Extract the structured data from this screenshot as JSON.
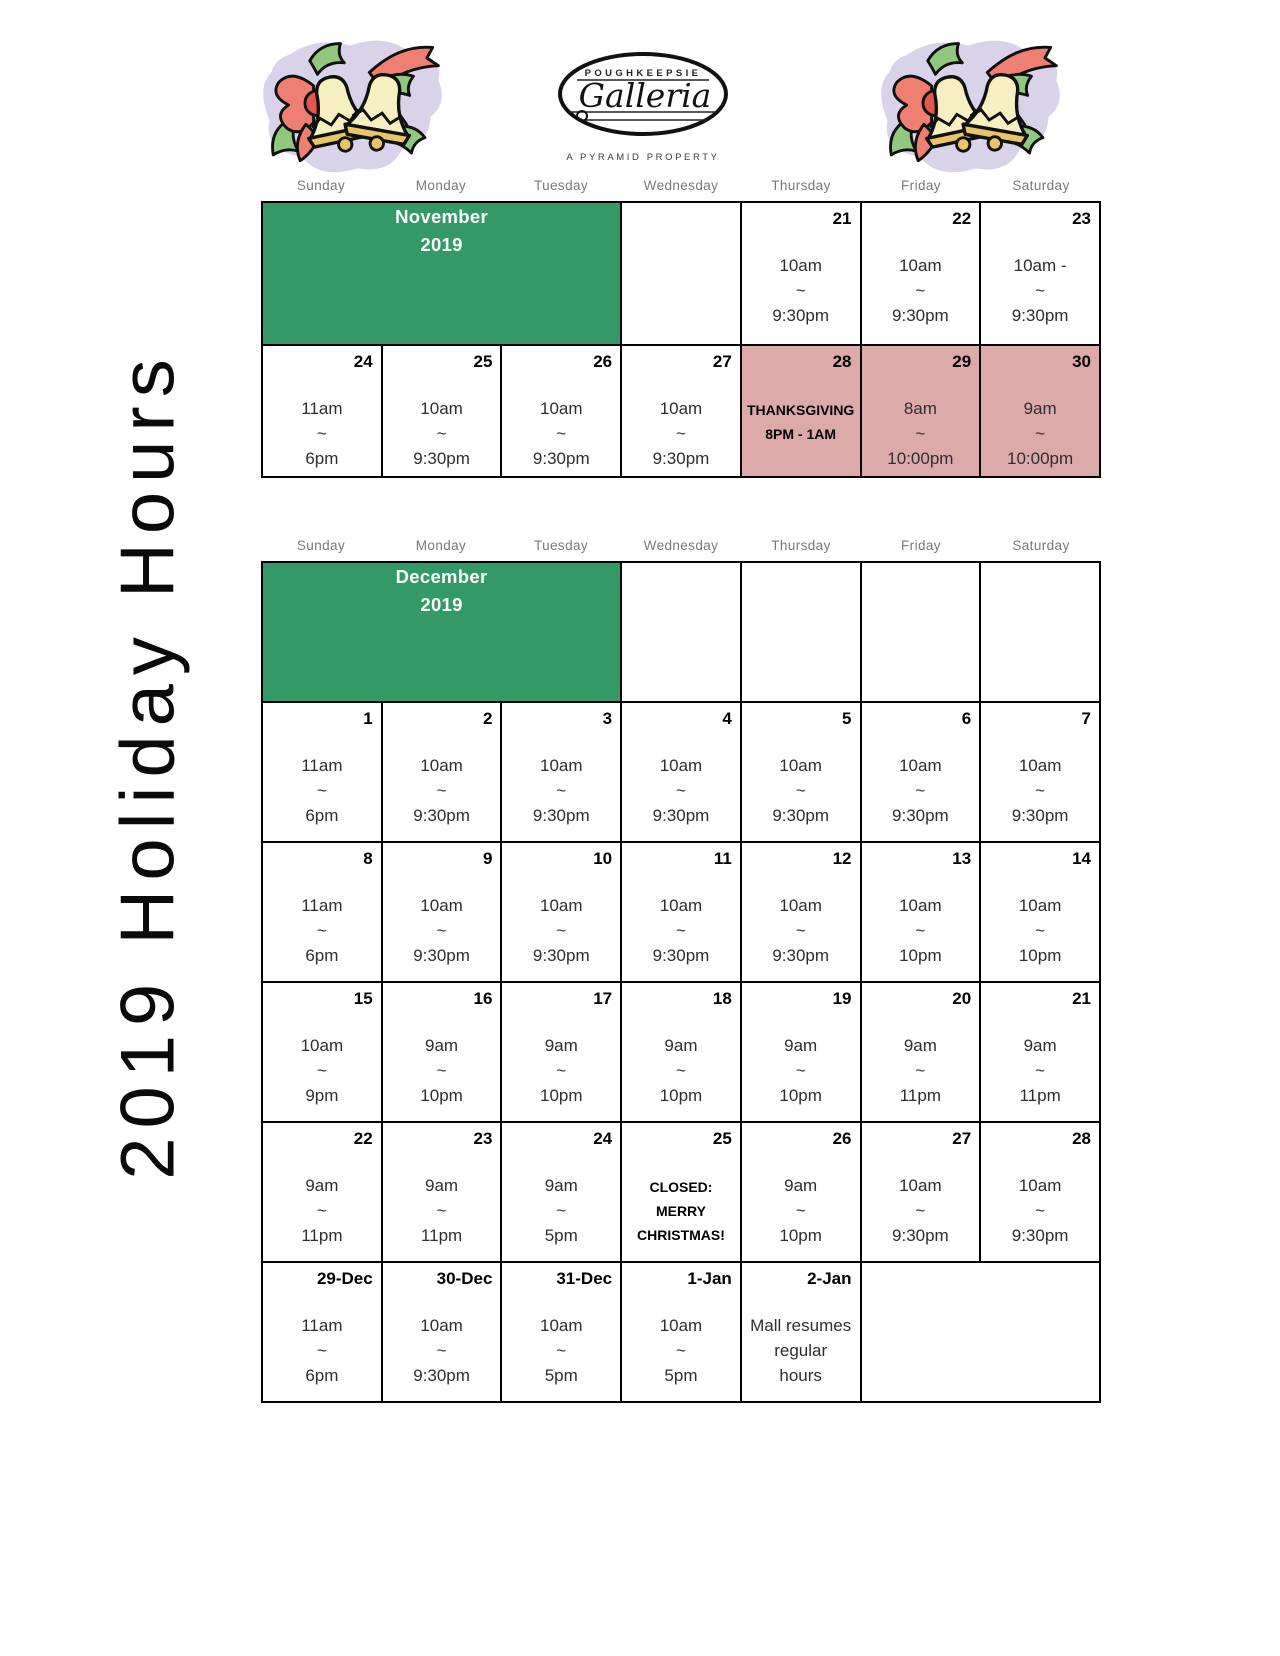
{
  "page": {
    "vertical_title": "2019 Holiday Hours"
  },
  "logo": {
    "name": "POUGHKEEPSIE",
    "script": "Galleria",
    "tagline": "A PYRAMID PROPERTY"
  },
  "weekdays": [
    "Sunday",
    "Monday",
    "Tuesday",
    "Wednesday",
    "Thursday",
    "Friday",
    "Saturday"
  ],
  "colors": {
    "month_green": "#339966",
    "holiday_pink": "#ddaaaa"
  },
  "months": [
    {
      "id": "november",
      "title_lines": [
        "November",
        "2019"
      ],
      "first_row_cells": [
        {
          "type": "empty"
        },
        {
          "date": "21",
          "lines": [
            "10am",
            "~",
            "9:30pm"
          ]
        },
        {
          "date": "22",
          "lines": [
            "10am",
            "~",
            "9:30pm"
          ]
        },
        {
          "date": "23",
          "lines": [
            "10am -",
            "~",
            "9:30pm"
          ]
        }
      ],
      "rows": [
        [
          {
            "date": "24",
            "lines": [
              "11am",
              "~",
              "6pm"
            ]
          },
          {
            "date": "25",
            "lines": [
              "10am",
              "~",
              "9:30pm"
            ]
          },
          {
            "date": "26",
            "lines": [
              "10am",
              "~",
              "9:30pm"
            ]
          },
          {
            "date": "27",
            "lines": [
              "10am",
              "~",
              "9:30pm"
            ]
          },
          {
            "date": "28",
            "lines": [
              "THANKSGIVING",
              "8PM - 1AM"
            ],
            "bold": true,
            "highlight": true
          },
          {
            "date": "29",
            "lines": [
              "8am",
              "~",
              "10:00pm"
            ],
            "highlight": true
          },
          {
            "date": "30",
            "lines": [
              "9am",
              "~",
              "10:00pm"
            ],
            "highlight": true
          }
        ]
      ]
    },
    {
      "id": "december",
      "title_lines": [
        "December",
        "2019"
      ],
      "first_row_cells": [
        {
          "type": "empty"
        },
        {
          "type": "empty"
        },
        {
          "type": "empty"
        },
        {
          "type": "empty"
        }
      ],
      "rows": [
        [
          {
            "date": "1",
            "lines": [
              "11am",
              "~",
              "6pm"
            ]
          },
          {
            "date": "2",
            "lines": [
              "10am",
              "~",
              "9:30pm"
            ]
          },
          {
            "date": "3",
            "lines": [
              "10am",
              "~",
              "9:30pm"
            ]
          },
          {
            "date": "4",
            "lines": [
              "10am",
              "~",
              "9:30pm"
            ]
          },
          {
            "date": "5",
            "lines": [
              "10am",
              "~",
              "9:30pm"
            ]
          },
          {
            "date": "6",
            "lines": [
              "10am",
              "~",
              "9:30pm"
            ]
          },
          {
            "date": "7",
            "lines": [
              "10am",
              "~",
              "9:30pm"
            ]
          }
        ],
        [
          {
            "date": "8",
            "lines": [
              "11am",
              "~",
              "6pm"
            ]
          },
          {
            "date": "9",
            "lines": [
              "10am",
              "~",
              "9:30pm"
            ]
          },
          {
            "date": "10",
            "lines": [
              "10am",
              "~",
              "9:30pm"
            ]
          },
          {
            "date": "11",
            "lines": [
              "10am",
              "~",
              "9:30pm"
            ]
          },
          {
            "date": "12",
            "lines": [
              "10am",
              "~",
              "9:30pm"
            ]
          },
          {
            "date": "13",
            "lines": [
              "10am",
              "~",
              "10pm"
            ]
          },
          {
            "date": "14",
            "lines": [
              "10am",
              "~",
              "10pm"
            ]
          }
        ],
        [
          {
            "date": "15",
            "lines": [
              "10am",
              "~",
              "9pm"
            ]
          },
          {
            "date": "16",
            "lines": [
              "9am",
              "~",
              "10pm"
            ]
          },
          {
            "date": "17",
            "lines": [
              "9am",
              "~",
              "10pm"
            ]
          },
          {
            "date": "18",
            "lines": [
              "9am",
              "~",
              "10pm"
            ]
          },
          {
            "date": "19",
            "lines": [
              "9am",
              "~",
              "10pm"
            ]
          },
          {
            "date": "20",
            "lines": [
              "9am",
              "~",
              "11pm"
            ]
          },
          {
            "date": "21",
            "lines": [
              "9am",
              "~",
              "11pm"
            ]
          }
        ],
        [
          {
            "date": "22",
            "lines": [
              "9am",
              "~",
              "11pm"
            ]
          },
          {
            "date": "23",
            "lines": [
              "9am",
              "~",
              "11pm"
            ]
          },
          {
            "date": "24",
            "lines": [
              "9am",
              "~",
              "5pm"
            ]
          },
          {
            "date": "25",
            "lines": [
              "CLOSED:",
              "MERRY",
              "CHRISTMAS!"
            ],
            "bold": true
          },
          {
            "date": "26",
            "lines": [
              "9am",
              "~",
              "10pm"
            ]
          },
          {
            "date": "27",
            "lines": [
              "10am",
              "~",
              "9:30pm"
            ]
          },
          {
            "date": "28",
            "lines": [
              "10am",
              "~",
              "9:30pm"
            ]
          }
        ],
        [
          {
            "date": "29-Dec",
            "lines": [
              "11am",
              "~",
              "6pm"
            ]
          },
          {
            "date": "30-Dec",
            "lines": [
              "10am",
              "~",
              "9:30pm"
            ]
          },
          {
            "date": "31-Dec",
            "lines": [
              "10am",
              "~",
              "5pm"
            ]
          },
          {
            "date": "1-Jan",
            "lines": [
              "10am",
              "~",
              "5pm"
            ]
          },
          {
            "date": "2-Jan",
            "lines": [
              "Mall resumes",
              "regular",
              "hours"
            ]
          },
          {
            "type": "absent"
          },
          {
            "type": "absent"
          }
        ]
      ]
    }
  ]
}
